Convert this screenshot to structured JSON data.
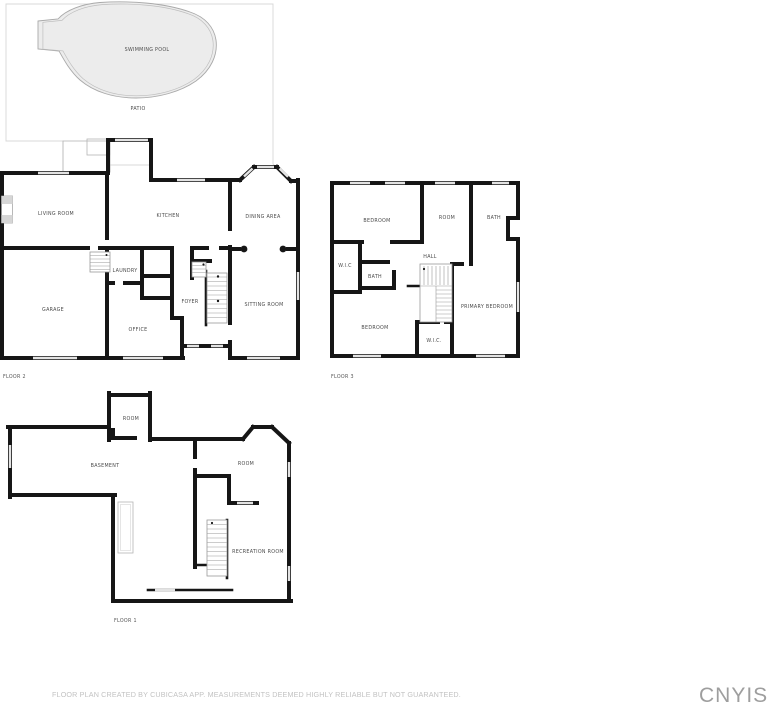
{
  "page": {
    "width": 770,
    "height": 710,
    "background": "#ffffff"
  },
  "outdoor": {
    "pool_label": "SWIMMING POOL",
    "patio_label": "PATIO"
  },
  "floors": [
    {
      "name": "FLOOR 2",
      "rooms": [
        {
          "label": "LIVING ROOM"
        },
        {
          "label": "KITCHEN"
        },
        {
          "label": "DINING AREA"
        },
        {
          "label": "LAUNDRY"
        },
        {
          "label": "GARAGE"
        },
        {
          "label": "FOYER"
        },
        {
          "label": "OFFICE"
        },
        {
          "label": "SITTING ROOM"
        }
      ]
    },
    {
      "name": "FLOOR 3",
      "rooms": [
        {
          "label": "BEDROOM"
        },
        {
          "label": "ROOM"
        },
        {
          "label": "BATH"
        },
        {
          "label": "W.I.C"
        },
        {
          "label": "BATH"
        },
        {
          "label": "HALL"
        },
        {
          "label": "BEDROOM"
        },
        {
          "label": "W.I.C."
        },
        {
          "label": "PRIMARY BEDROOM"
        }
      ]
    },
    {
      "name": "FLOOR 1",
      "rooms": [
        {
          "label": "ROOM"
        },
        {
          "label": "BASEMENT"
        },
        {
          "label": "ROOM"
        },
        {
          "label": "RECREATION ROOM"
        }
      ]
    }
  ],
  "footer": {
    "disclaimer": "FLOOR PLAN CREATED BY CUBICASA APP. MEASUREMENTS DEEMED HIGHLY RELIABLE BUT NOT GUARANTEED.",
    "watermark": "CNYIS"
  },
  "colors": {
    "wall": "#161616",
    "window": "#e3e3e3",
    "pool_fill": "#ececec",
    "pool_stroke": "#a9a9a9",
    "patio_stroke": "#d8d8d8",
    "room_label": "#4c4c4c",
    "disclaimer_text": "#c2c2c2",
    "watermark_text": "#9e9e9e"
  }
}
